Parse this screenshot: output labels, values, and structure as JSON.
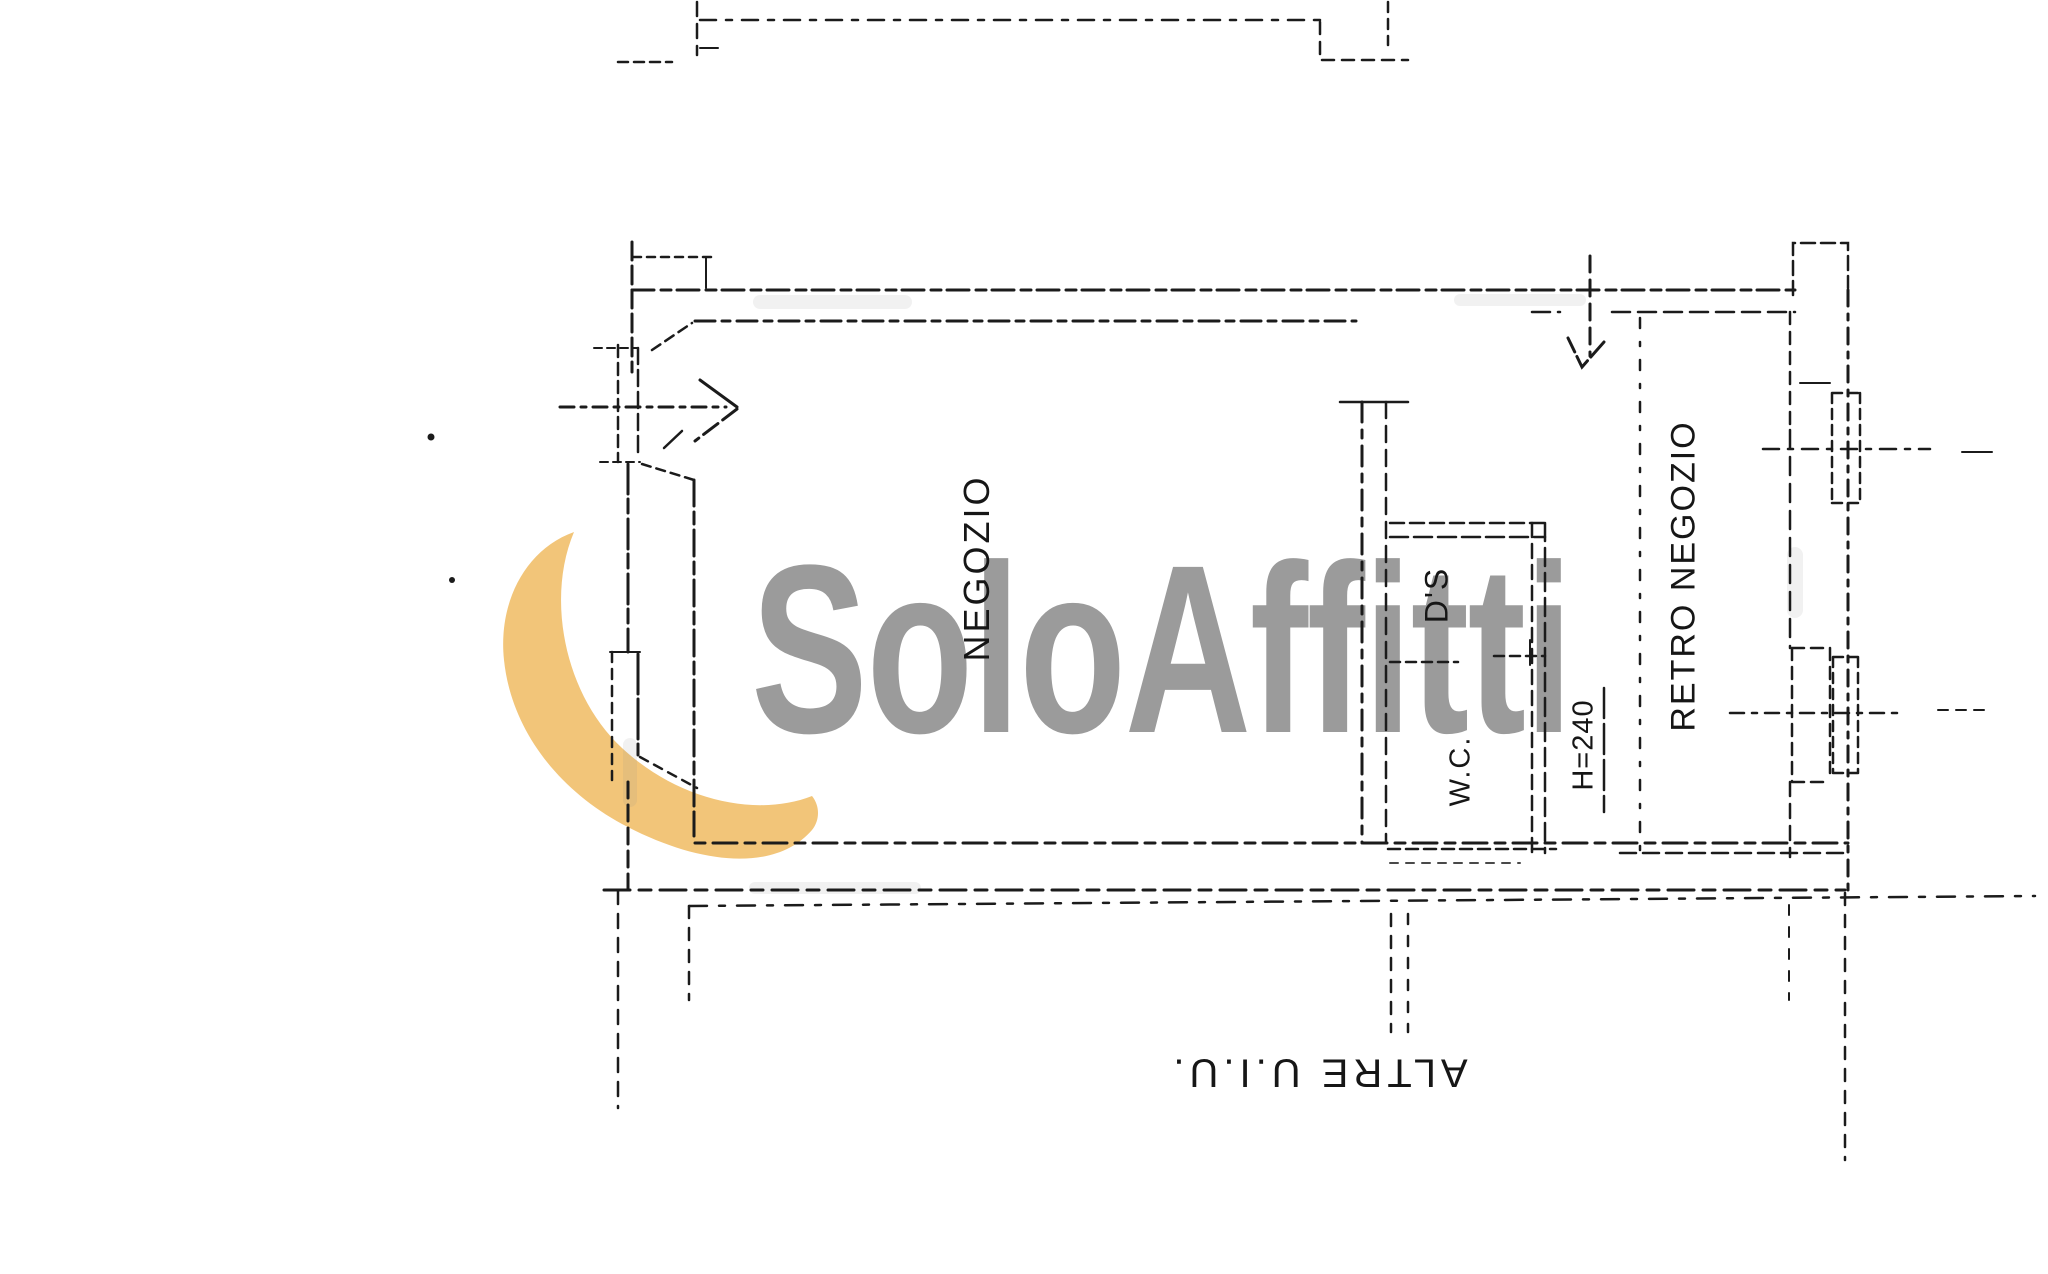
{
  "watermark": {
    "brand_text": "SoloAffitti",
    "text_color": "#9b9b9b",
    "swoosh_color": "#f2c579"
  },
  "plan": {
    "ink_color": "#1b1b1b",
    "labels": {
      "shop": "NEGOZIO",
      "back_shop": "RETRO NEGOZIO",
      "ds": "D'S",
      "wc": "W.C.",
      "ceiling_height": "H=240",
      "other_units": "ALTRE U.I.U."
    }
  }
}
